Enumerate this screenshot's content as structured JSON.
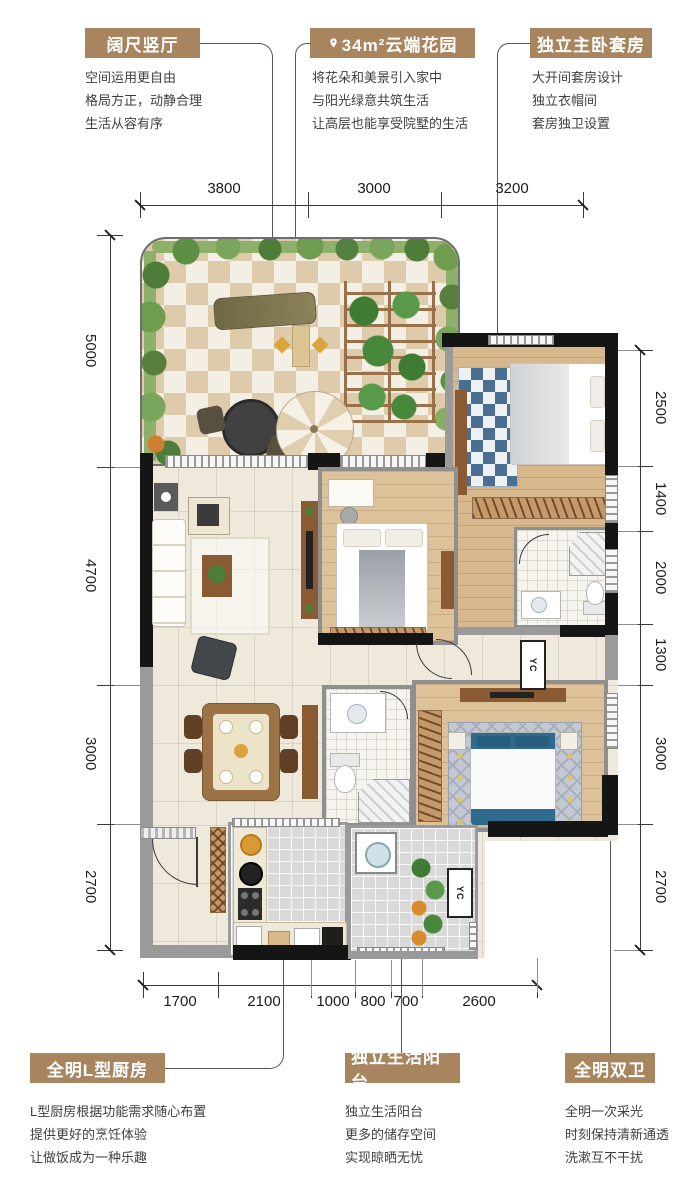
{
  "palette": {
    "accent": "#a8855f",
    "wall_dark": "#151515",
    "wall_gray": "#9a9a9a",
    "leader": "#555555"
  },
  "callouts": {
    "top": [
      {
        "title": "阔尺竖厅",
        "lines": [
          "空间运用更自由",
          "格局方正，动静合理",
          "生活从容有序"
        ]
      },
      {
        "title": "34m²云端花园",
        "lines": [
          "将花朵和美景引入家中",
          "与阳光绿意共筑生活",
          "让高层也能享受院墅的生活"
        ]
      },
      {
        "title": "独立主卧套房",
        "lines": [
          "大开间套房设计",
          "独立衣帽间",
          "套房独卫设置"
        ]
      }
    ],
    "bottom": [
      {
        "title": "全明L型厨房",
        "lines": [
          "L型厨房根据功能需求随心布置",
          "提供更好的烹饪体验",
          "让做饭成为一种乐趣"
        ]
      },
      {
        "title": "独立生活阳台",
        "lines": [
          "独立生活阳台",
          "更多的储存空间",
          "实现晾晒无忧"
        ]
      },
      {
        "title": "全明双卫",
        "lines": [
          "全明一次采光",
          "时刻保持清新通透",
          "洗漱互不干扰"
        ]
      }
    ]
  },
  "dims": {
    "top": [
      "3800",
      "3000",
      "3200"
    ],
    "left": [
      "5000",
      "4700",
      "3000",
      "2700"
    ],
    "right": [
      "2500",
      "1400",
      "2000",
      "1300",
      "3000",
      "2700"
    ],
    "bottom": [
      "1700",
      "2100",
      "1000",
      "800",
      "700",
      "2600"
    ]
  },
  "plan": {
    "duct_label": "YC"
  }
}
